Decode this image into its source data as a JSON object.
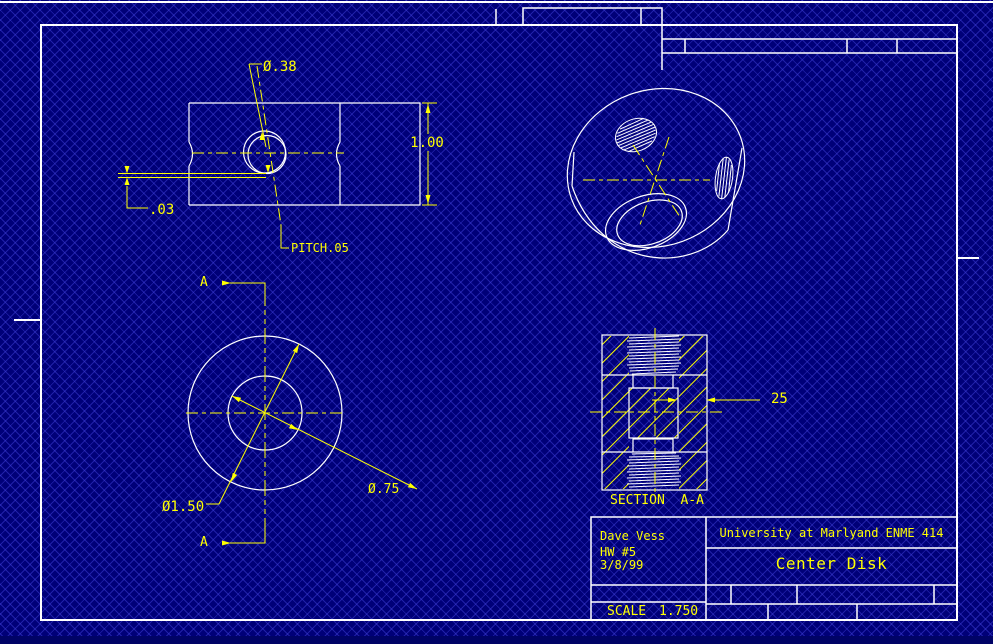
{
  "sheet": {
    "background_color": "#000078",
    "pattern_color": "#4040d8",
    "geometry_color": "#ffffff",
    "annotation_color": "#ffff00"
  },
  "views": {
    "front": {
      "hole_dia": "Ø.38",
      "height": "1.00",
      "offset": ".03",
      "pitch": "PITCH.05"
    },
    "plan": {
      "outer_dia": "Ø1.50",
      "bore_dia": "Ø.75",
      "cut_label": "A"
    },
    "section": {
      "wall": "25",
      "title": "SECTION  A-A"
    }
  },
  "title_block": {
    "author": "Dave Vess",
    "assignment": "HW #5",
    "date": "3/8/99",
    "organization": "University at Marlyand ENME 414",
    "drawing_title": "Center Disk",
    "scale_label": "SCALE",
    "scale_value": "1.750"
  }
}
